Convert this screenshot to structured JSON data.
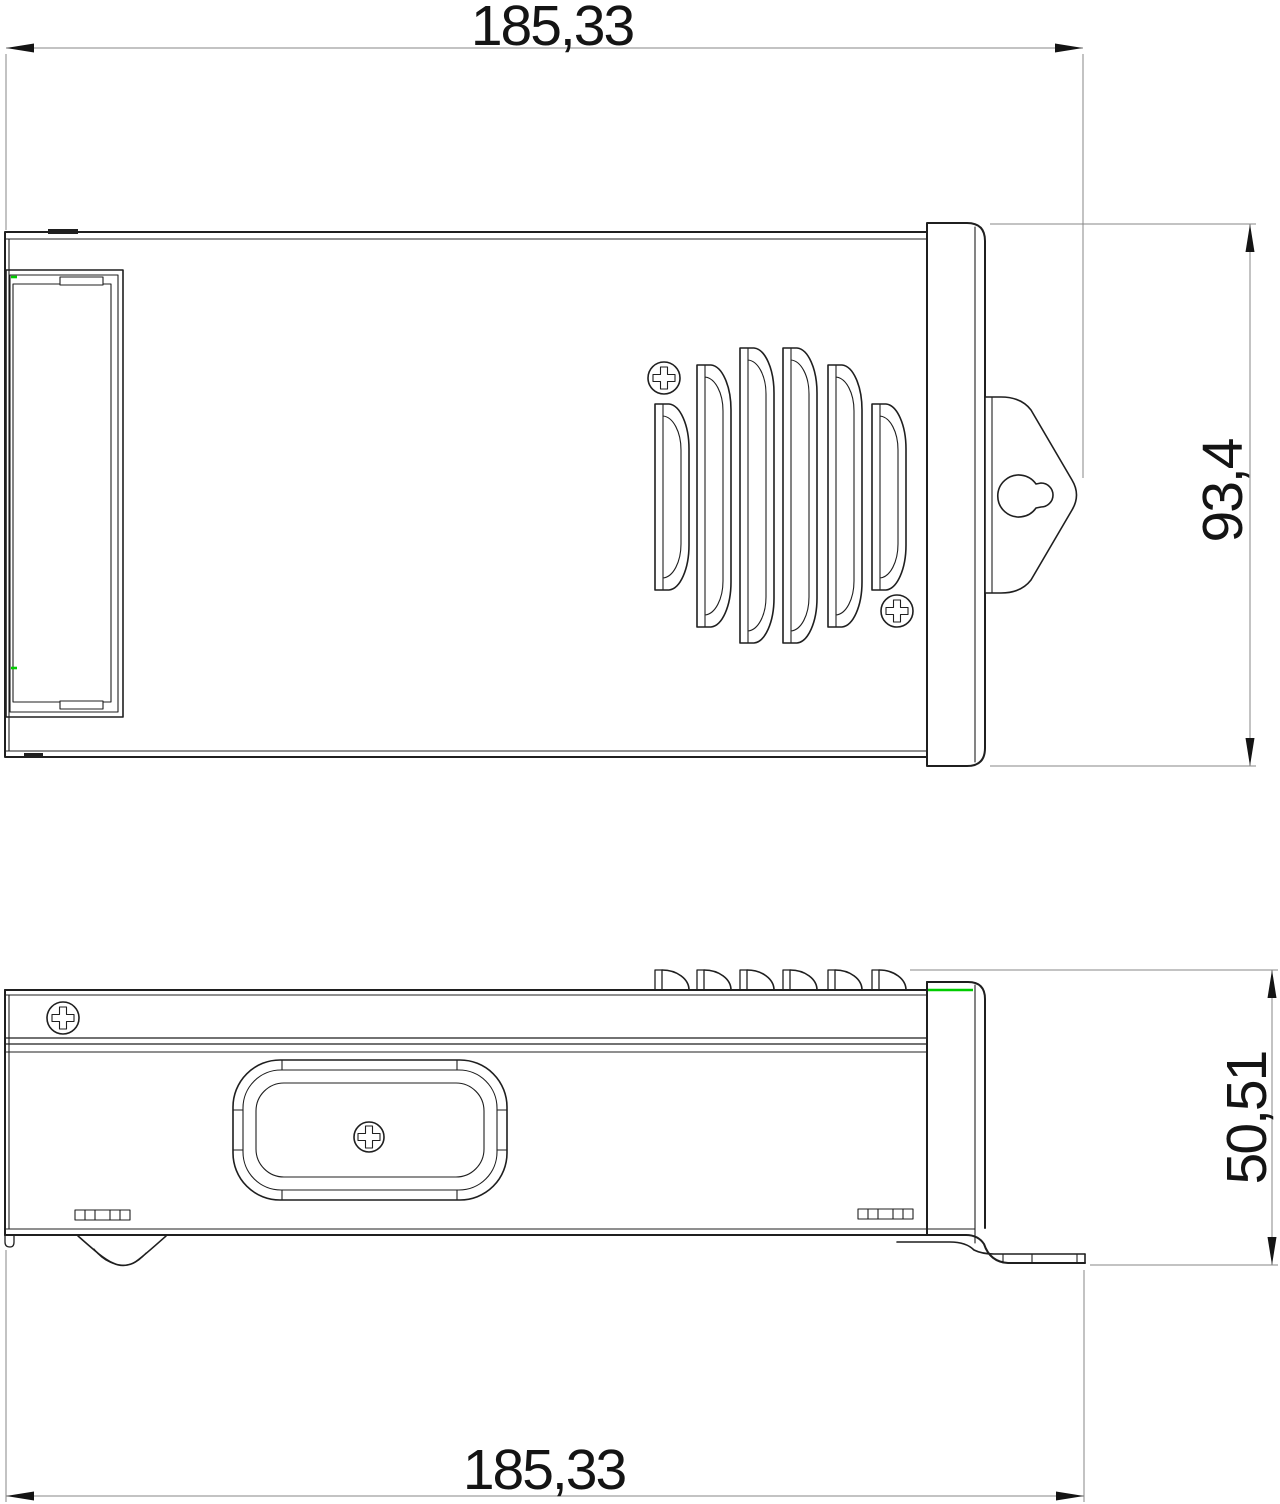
{
  "drawing": {
    "type": "cad-dimension-drawing",
    "views": {
      "top_view": {
        "name": "top view"
      },
      "side_view": {
        "name": "side view"
      }
    },
    "dimensions": {
      "top_width": "185,33",
      "overall_height": "93,4",
      "side_height": "50,51",
      "bottom_width": "185,33"
    },
    "colors": {
      "outline": "#1f1f1f",
      "dim_line": "#878787",
      "dim_text": "#141414",
      "accent_green": "#00cc00",
      "background": "#ffffff"
    }
  }
}
